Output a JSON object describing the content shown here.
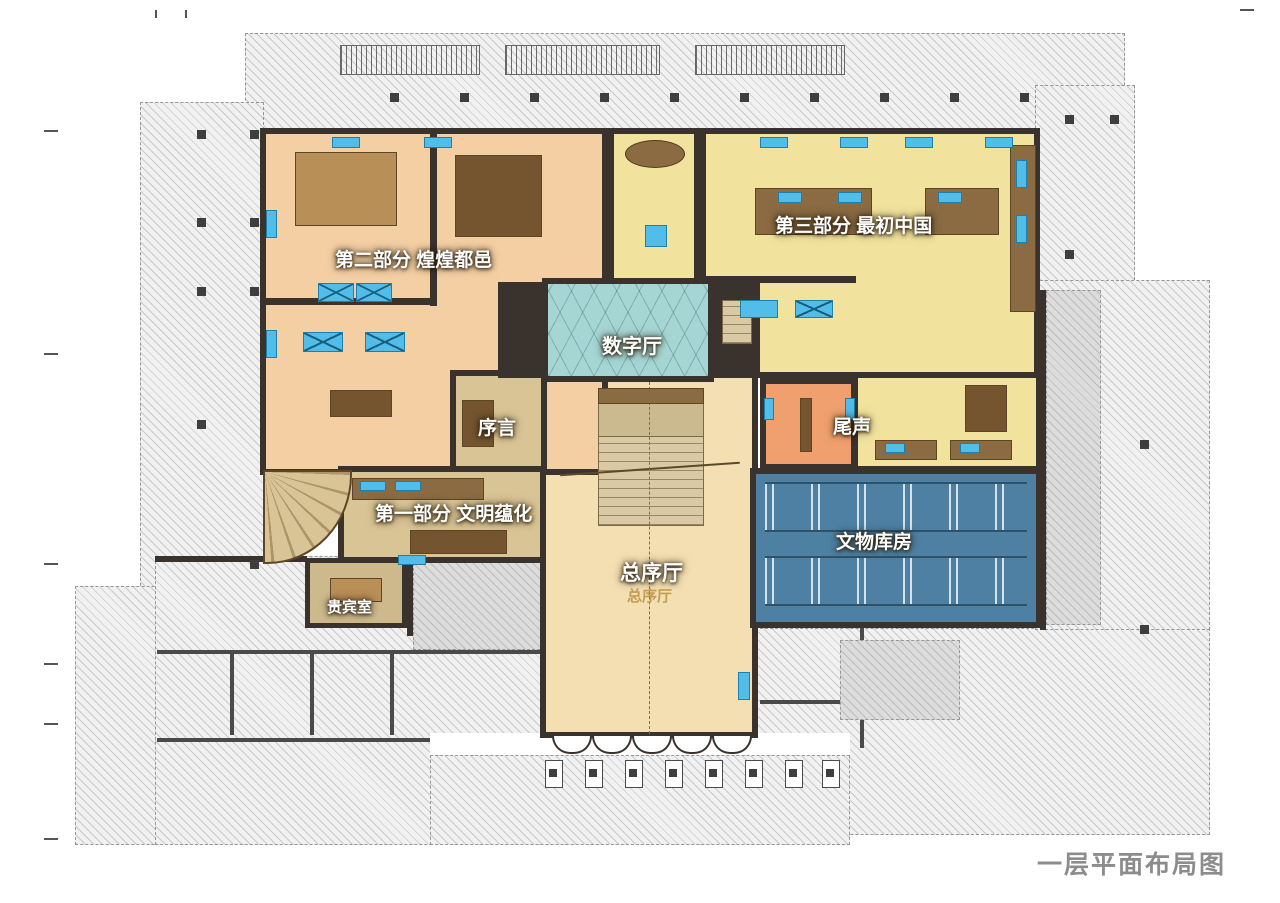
{
  "title": "一层平面布局图",
  "colors": {
    "wall": "#3a332d",
    "part2": "#f4cfa4",
    "part3": "#f1e29e",
    "digital": "#a6d6d4",
    "lobby": "#f3dfb2",
    "tan": "#d9c495",
    "epilogue": "#efa06e",
    "storage": "#4d80a2",
    "vip": "#cdb98c",
    "case": "#52bde8",
    "title-color": "#8c8c8c"
  },
  "rooms": {
    "part2": {
      "label": "第二部分 煌煌都邑"
    },
    "part3": {
      "label": "第三部分 最初中国"
    },
    "digital_hall": {
      "label": "数字厅"
    },
    "preface": {
      "label": "序言"
    },
    "part1": {
      "label": "第一部分 文明蕴化"
    },
    "main_hall": {
      "label": "总序厅",
      "sublabel": "总序厅"
    },
    "epilogue": {
      "label": "尾声"
    },
    "storage": {
      "label": "文物库房"
    },
    "vip": {
      "label": "贵宾室"
    }
  }
}
